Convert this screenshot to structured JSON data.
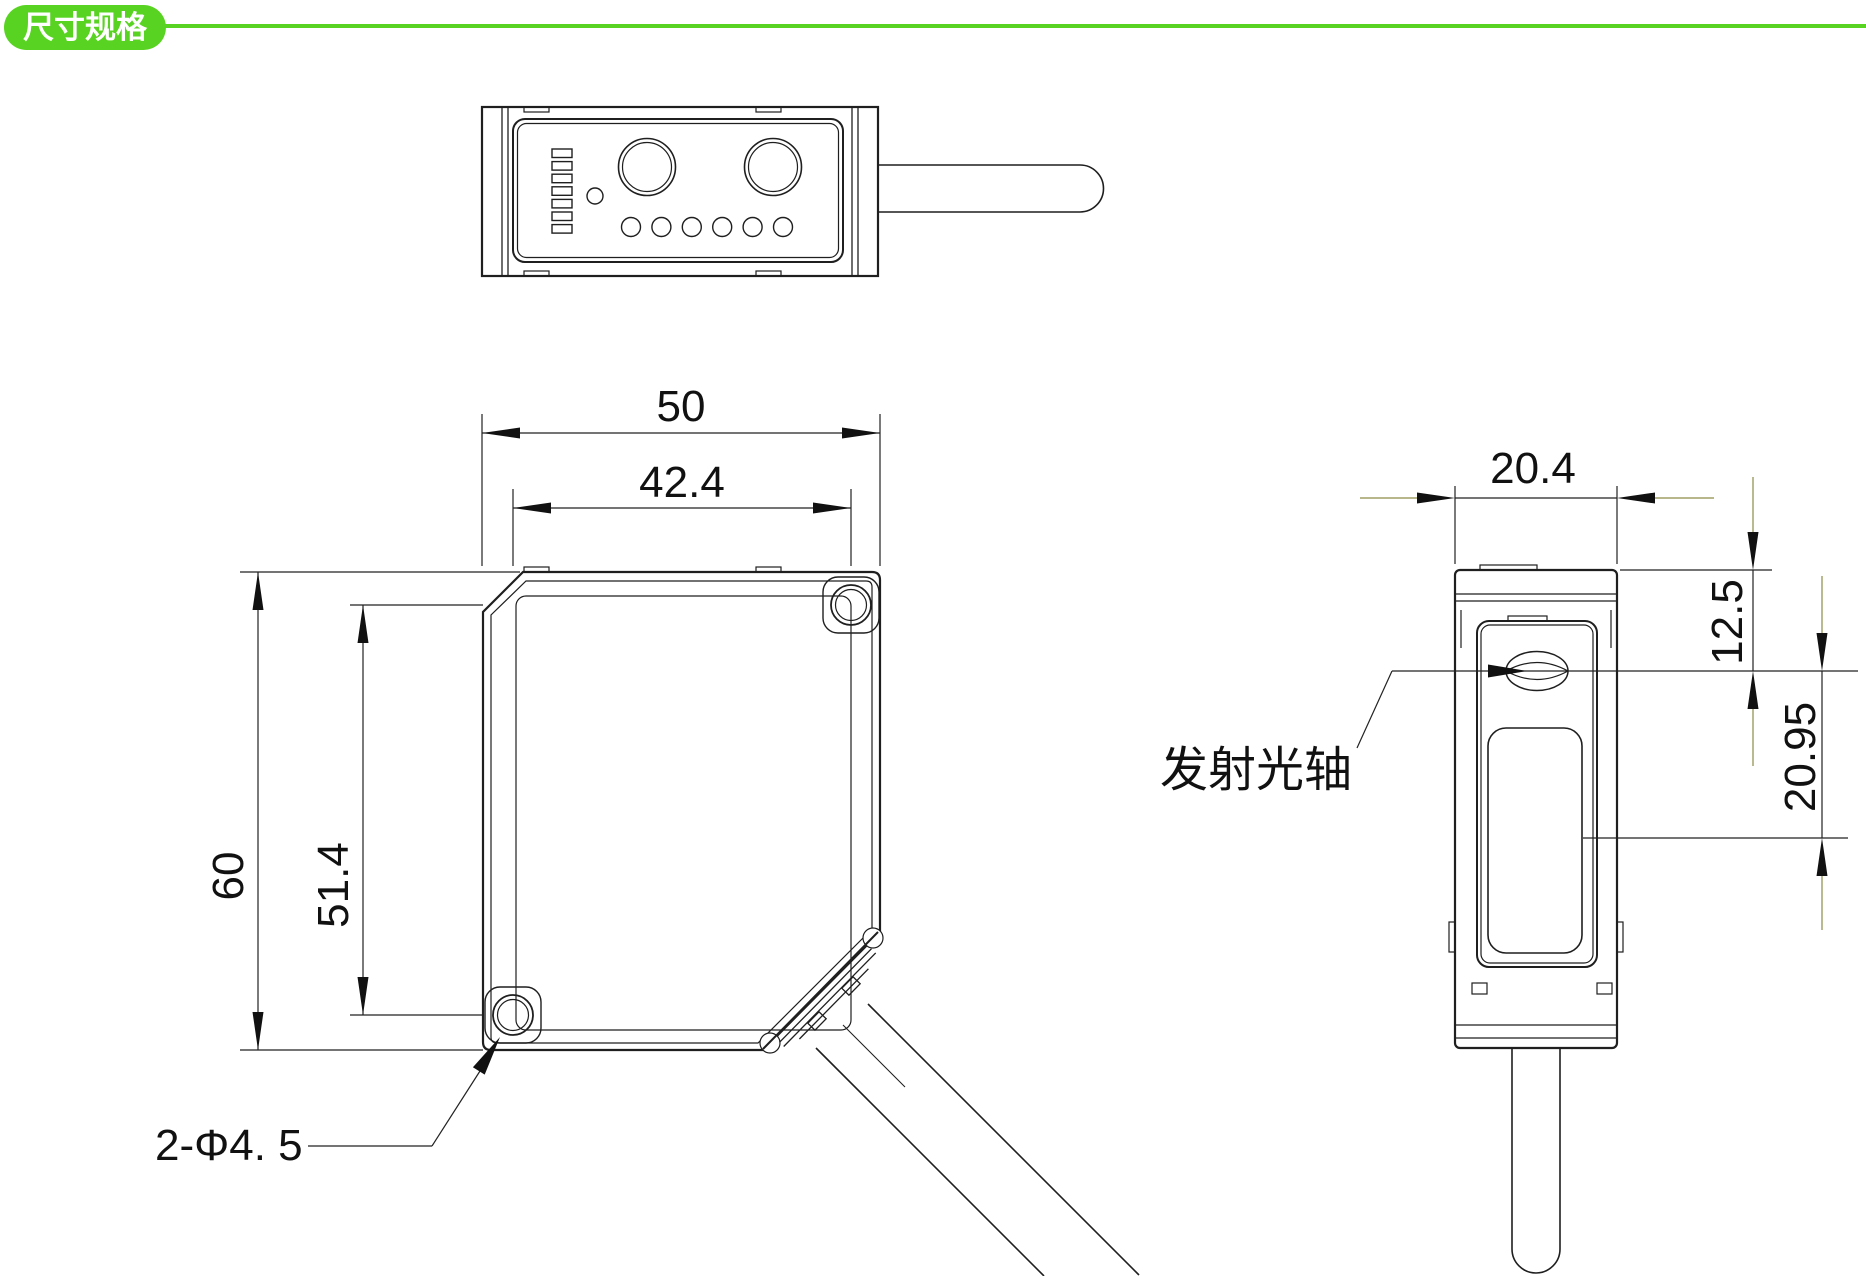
{
  "header": {
    "badge_label": "尺寸规格"
  },
  "colors": {
    "accent_green": "#58D321",
    "dim_tail_olive": "#8C8C46",
    "line_dark": "#1F1F1F"
  },
  "front_view": {
    "dim_width": "50",
    "dim_hole_span_h": "42.4",
    "dim_height": "60",
    "dim_hole_span_v": "51.4",
    "hole_callout": "2-Φ4. 5"
  },
  "side_view": {
    "dim_width": "20.4",
    "dim_axis_from_top": "12.5",
    "dim_axis_to_window": "20.95",
    "emission_axis_label": "发射光轴"
  }
}
